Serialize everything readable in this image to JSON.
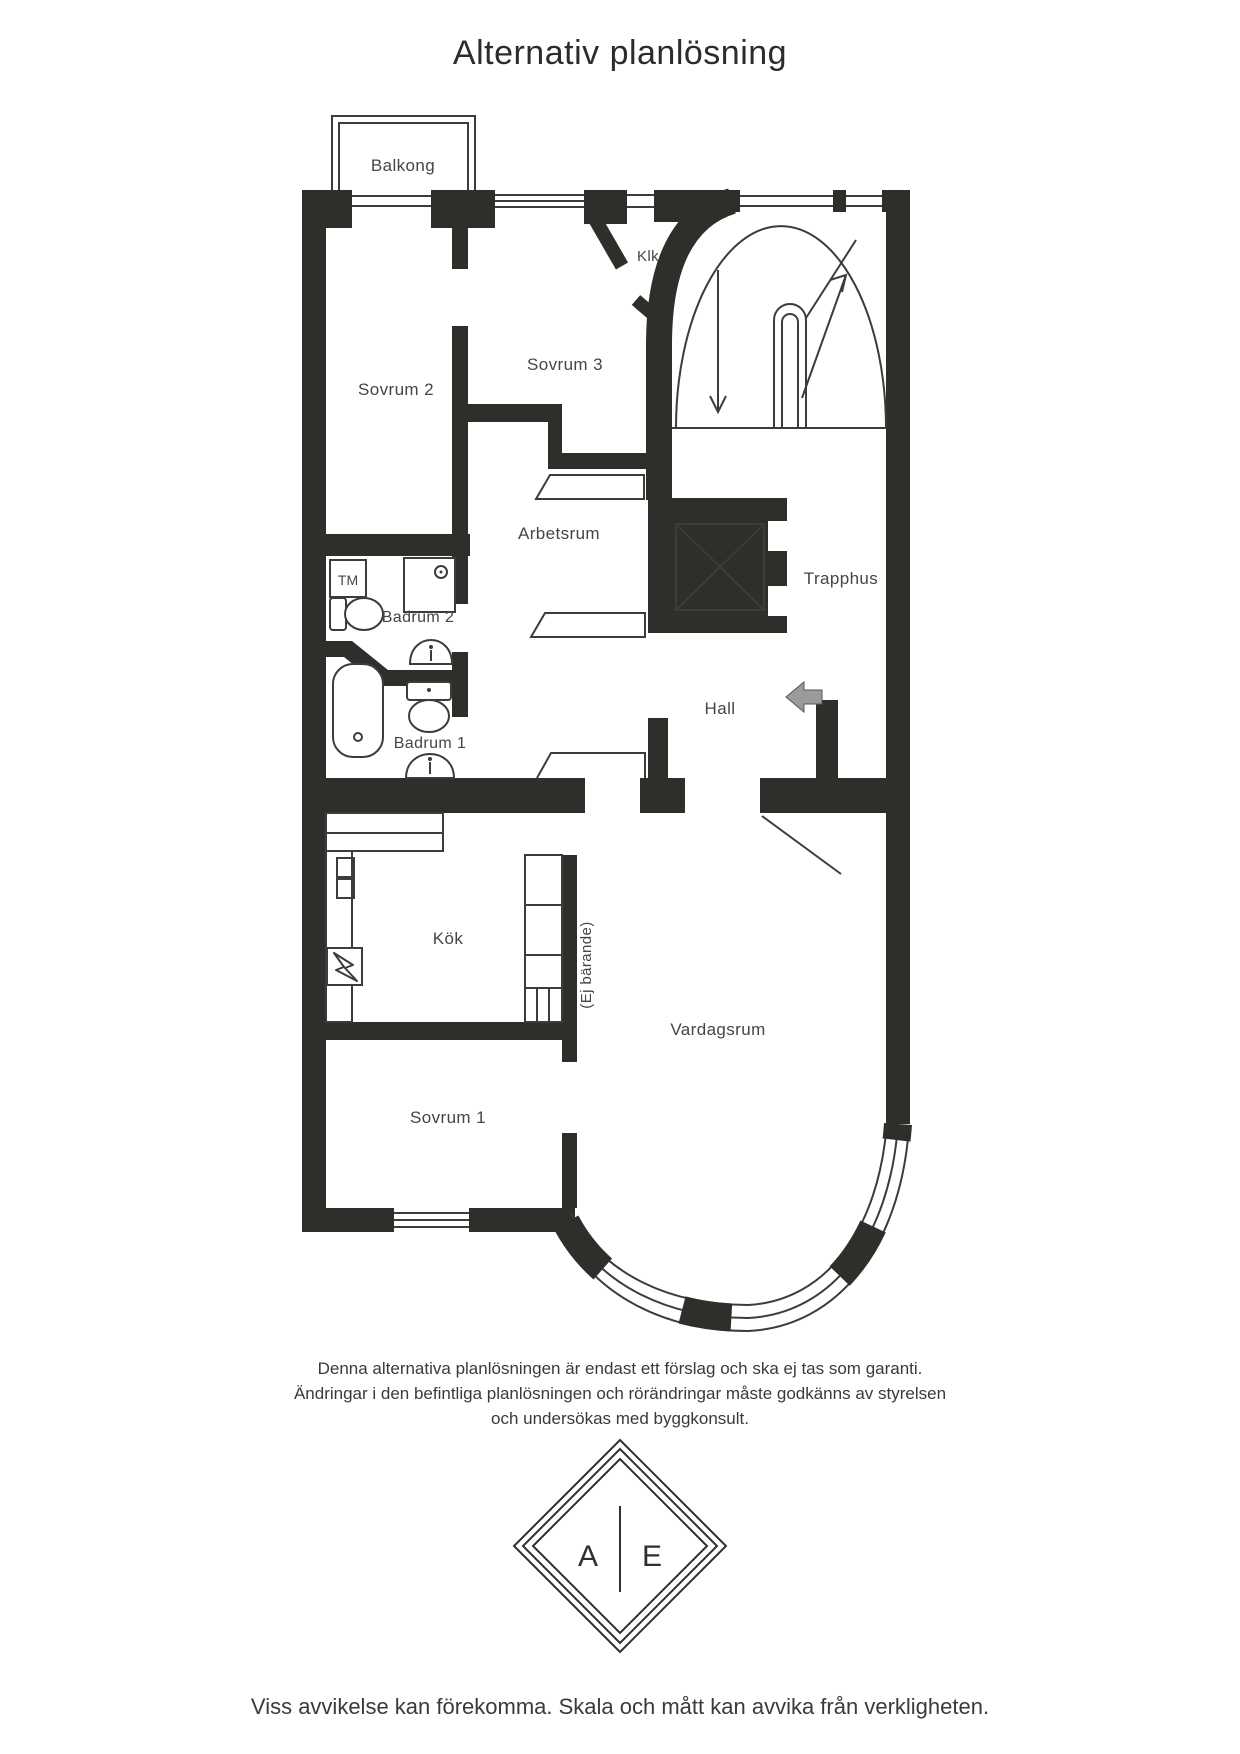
{
  "page": {
    "title": "Alternativ planlösning",
    "disclaimer_lines": [
      "Denna alternativa planlösningen är endast ett förslag och ska ej tas som garanti.",
      "Ändringar i den befintliga planlösningen och rörändringar måste godkänns av styrelsen",
      "och undersökas med byggkonsult."
    ],
    "footnote": "Viss avvikelse kan förekomma. Skala och mått kan avvika från verkligheten."
  },
  "rooms": {
    "balkong": {
      "label": "Balkong"
    },
    "klk": {
      "label": "Klk"
    },
    "sovrum2": {
      "label": "Sovrum 2"
    },
    "sovrum3": {
      "label": "Sovrum 3"
    },
    "arbetsrum": {
      "label": "Arbetsrum"
    },
    "trapphus": {
      "label": "Trapphus"
    },
    "badrum2": {
      "label": "Badrum 2"
    },
    "badrum1": {
      "label": "Badrum 1"
    },
    "hall": {
      "label": "Hall"
    },
    "kok": {
      "label": "Kök"
    },
    "vardagsrum": {
      "label": "Vardagsrum"
    },
    "sovrum1": {
      "label": "Sovrum 1"
    }
  },
  "annotations": {
    "tm": "TM",
    "ej_barande": "(Ej bärande)"
  },
  "logo": {
    "left_letter": "A",
    "right_letter": "E"
  },
  "colors": {
    "wall": "#2e2e2b",
    "line": "#3c3c3c",
    "label": "#454545",
    "entry_arrow": "#9b9b9b",
    "background": "#ffffff"
  }
}
